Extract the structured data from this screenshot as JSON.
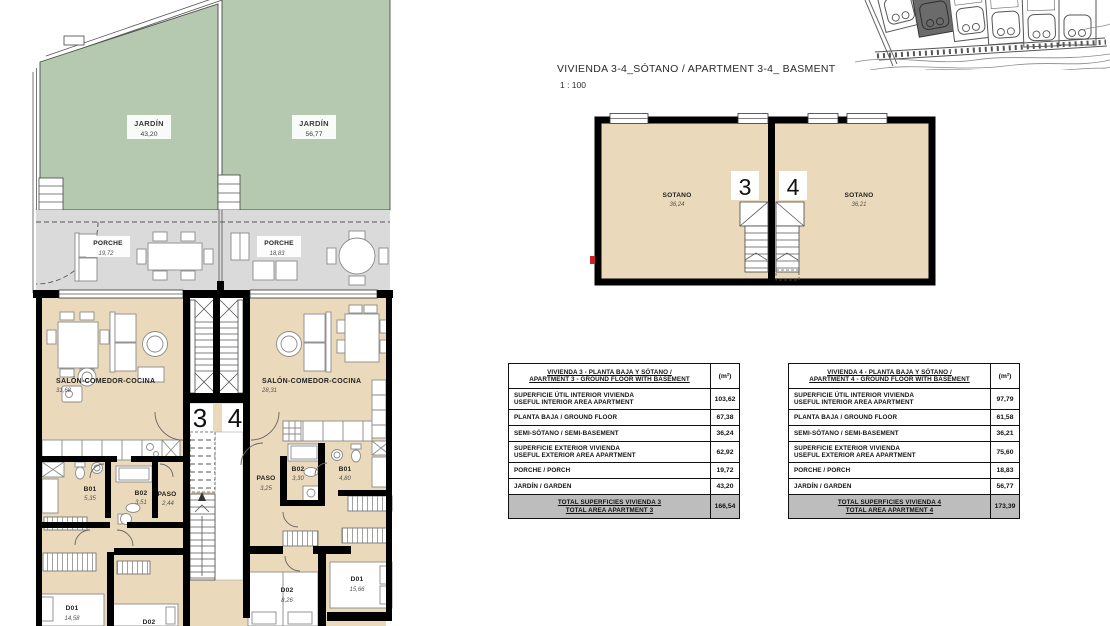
{
  "colors": {
    "garden_green": "#b5c9b0",
    "floor_beige": "#ebd9bb",
    "porch_gray": "#dadada",
    "wall_black": "#000000",
    "total_row_gray": "#bdbdbd",
    "red_mark": "#cc2222",
    "site_highlight": "#6b6b6b"
  },
  "basement_plan": {
    "title": "VIVIENDA 3-4_SÓTANO / APARTMENT 3-4_ BASMENT",
    "scale": "1 : 100",
    "unit3_number": "3",
    "unit4_number": "4",
    "room3": {
      "name": "SOTANO",
      "area": "36,24"
    },
    "room4": {
      "name": "SOTANO",
      "area": "36,21"
    }
  },
  "ground_floor_plan": {
    "unit3_number": "3",
    "unit4_number": "4",
    "jardin3": {
      "name": "JARDÍN",
      "area": "43,20"
    },
    "jardin4": {
      "name": "JARDÍN",
      "area": "56,77"
    },
    "porche3": {
      "name": "PORCHE",
      "area": "19,72"
    },
    "porche4": {
      "name": "PORCHE",
      "area": "18,83"
    },
    "salon3": {
      "name": "SALÓN-COMEDOR-COCINA",
      "area": "31,68"
    },
    "salon4": {
      "name": "SALÓN-COMEDOR-COCINA",
      "area": "28,31"
    },
    "b01_3": {
      "name": "B01",
      "area": "5,35"
    },
    "b02_3": {
      "name": "B02",
      "area": "3,51"
    },
    "paso_3": {
      "name": "PASO",
      "area": "2,44"
    },
    "d01_3": {
      "name": "D01",
      "area": "14,58"
    },
    "d02_3": {
      "name": "D02"
    },
    "paso_4": {
      "name": "PASO",
      "area": "3,25"
    },
    "b02_4": {
      "name": "B02",
      "area": "3,30"
    },
    "b01_4": {
      "name": "B01",
      "area": "4,80"
    },
    "d02_4": {
      "name": "D02",
      "area": "8,26"
    },
    "d01_4": {
      "name": "D01",
      "area": "15,66"
    }
  },
  "tables": {
    "apt3": {
      "title1": "VIVIENDA 3 - PLANTA BAJA Y SÓTANO /",
      "title2": "APARTMENT 3 - GROUND FLOOR WITH BASEMENT",
      "unit": "(m²)",
      "rows": [
        {
          "l1": "SUPERFICIE ÚTIL INTERIOR VIVIENDA",
          "l2": "USEFUL INTERIOR AREA APARTMENT",
          "v": "103,62"
        },
        {
          "l1": "PLANTA BAJA / GROUND FLOOR",
          "v": "67,38"
        },
        {
          "l1": "SEMI-SÓTANO / SEMI-BASEMENT",
          "v": "36,24"
        },
        {
          "l1": "SUPERFICIE EXTERIOR VIVIENDA",
          "l2": "USEFUL EXTERIOR AREA APARTMENT",
          "v": "62,92"
        },
        {
          "l1": "PORCHE / PORCH",
          "v": "19,72"
        },
        {
          "l1": "JARDÍN / GARDEN",
          "v": "43,20"
        }
      ],
      "total1": "TOTAL SUPERFICIES VIVIENDA 3",
      "total2": "TOTAL AREA APARTMENT 3",
      "total_value": "166,54"
    },
    "apt4": {
      "title1": "VIVIENDA 4 - PLANTA BAJA Y SÓTANO /",
      "title2": "APARTMENT 4 - GROUND FLOOR WITH BASEMENT",
      "unit": "(m²)",
      "rows": [
        {
          "l1": "SUPERFICIE ÚTIL INTERIOR VIVIENDA",
          "l2": "USEFUL INTERIOR AREA APARTMENT",
          "v": "97,79"
        },
        {
          "l1": "PLANTA BAJA / GROUND FLOOR",
          "v": "61,58"
        },
        {
          "l1": "SEMI-SÓTANO / SEMI-BASEMENT",
          "v": "36,21"
        },
        {
          "l1": "SUPERFICIE EXTERIOR VIVIENDA",
          "l2": "USEFUL EXTERIOR AREA APARTMENT",
          "v": "75,60"
        },
        {
          "l1": "PORCHE / PORCH",
          "v": "18,83"
        },
        {
          "l1": "JARDÍN / GARDEN",
          "v": "56,77"
        }
      ],
      "total1": "TOTAL SUPERFICIES VIVIENDA 4",
      "total2": "TOTAL AREA APARTMENT 4",
      "total_value": "173,39"
    }
  }
}
